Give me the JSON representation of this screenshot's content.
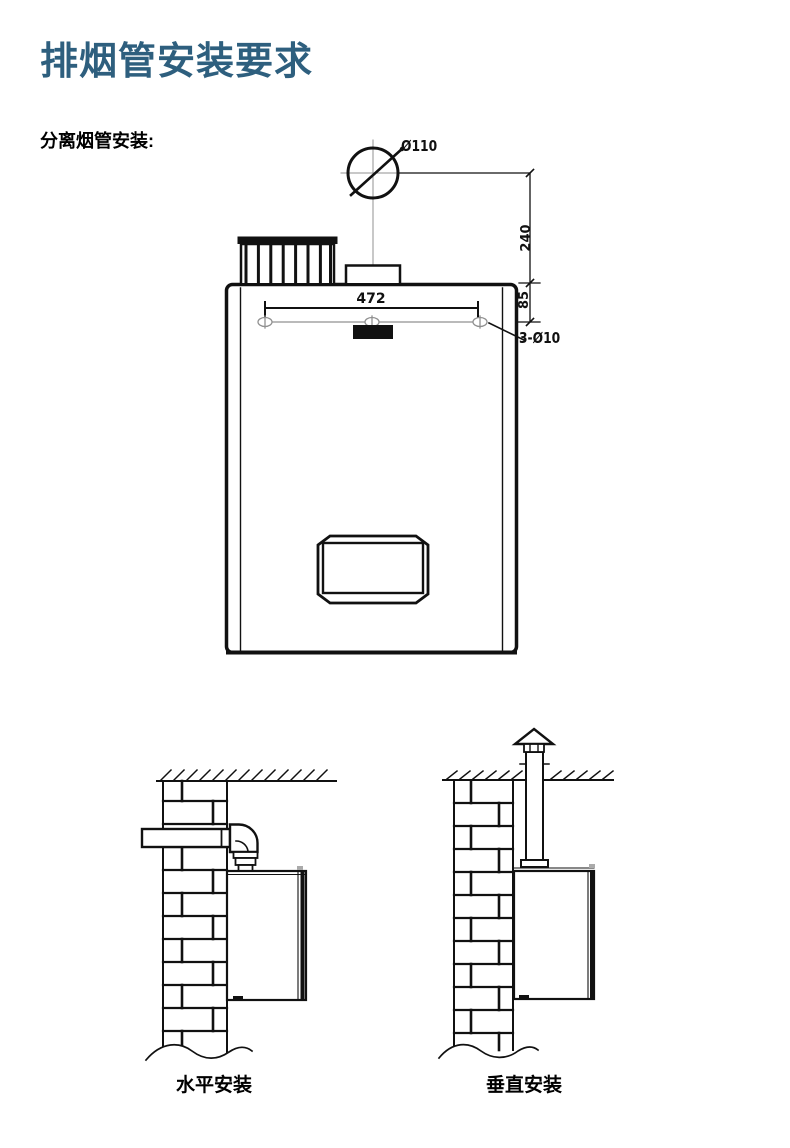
{
  "header": {
    "title": "排烟管安装要求"
  },
  "section": {
    "label": "分离烟管安装:"
  },
  "main_diagram": {
    "dims": {
      "flue_diameter": "Ø110",
      "flue_center_height": "240",
      "hole_line_offset": "85",
      "hole_spacing": "472",
      "mounting_holes": "3-Ø10"
    }
  },
  "install_diagrams": {
    "horizontal_label": "水平安装",
    "vertical_label": "垂直安装"
  },
  "colors": {
    "title_color": "#2e5f7e",
    "line_color": "#111111",
    "thin_line_color": "#909090",
    "background": "#ffffff"
  }
}
